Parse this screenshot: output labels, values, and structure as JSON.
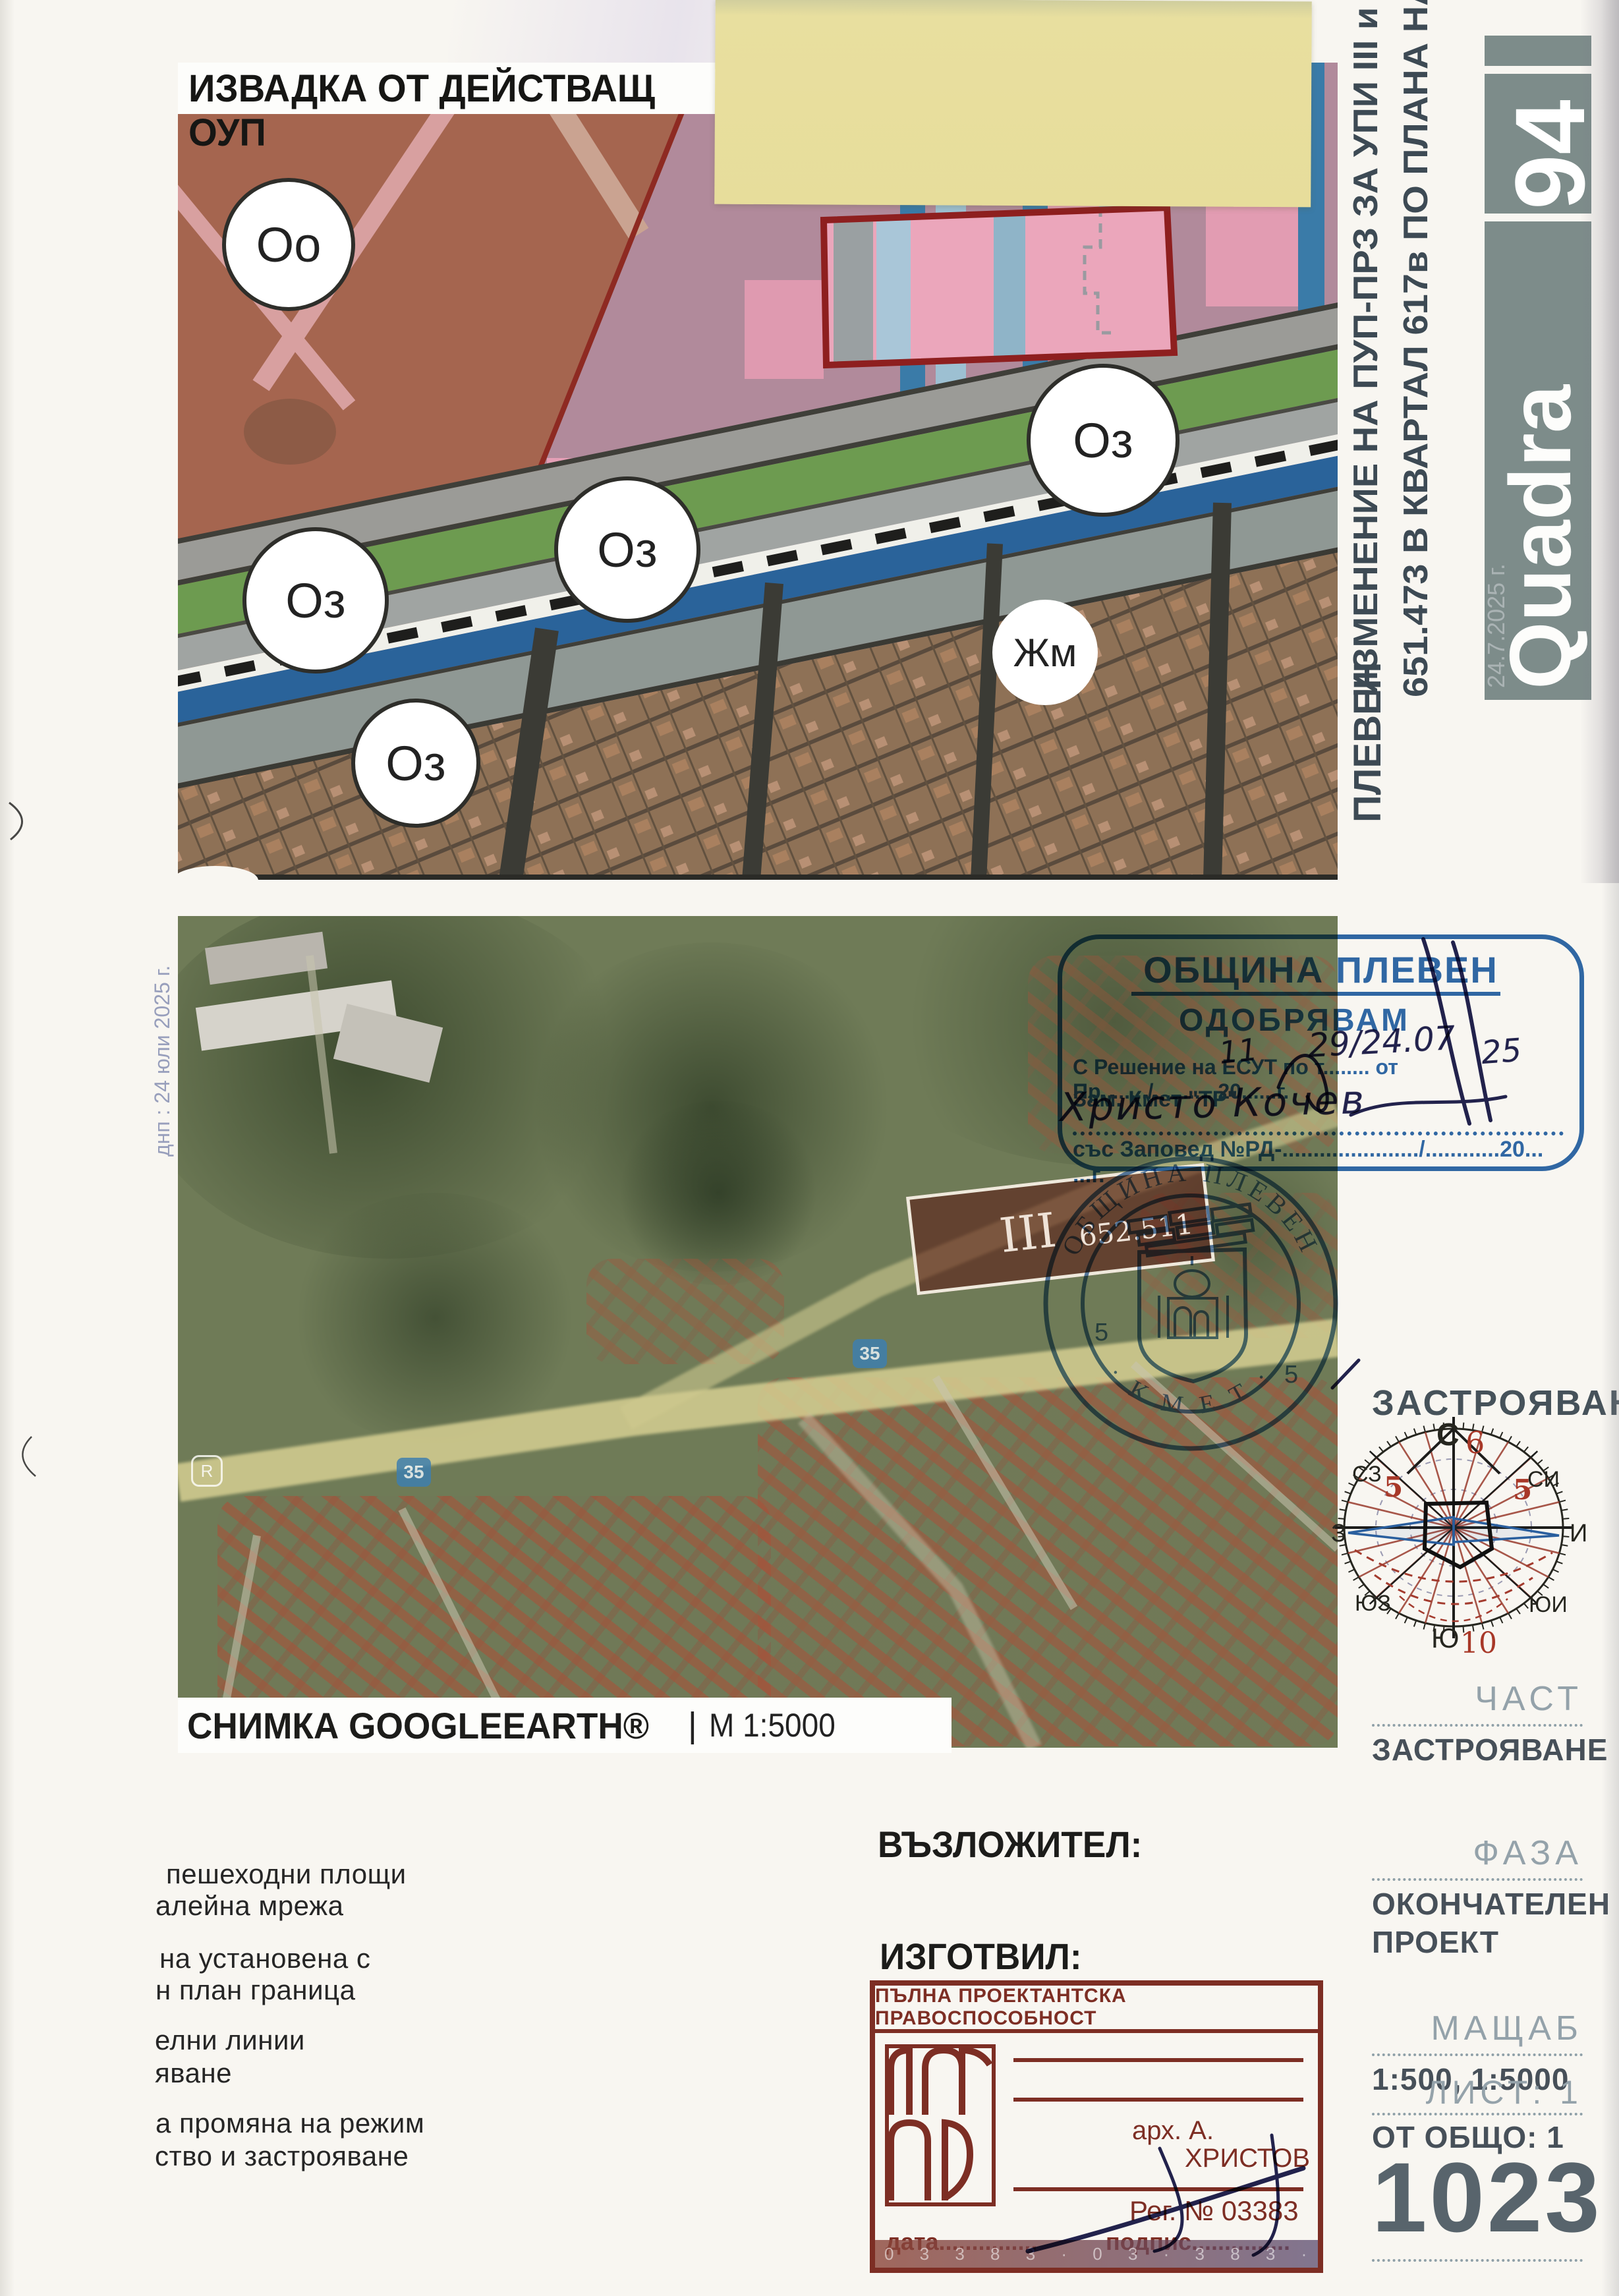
{
  "scan": {
    "fold_note": "днп : 24 юли 2025 г."
  },
  "zoning": {
    "title": "ИЗВАДКА ОТ ДЕЙСТВАЩ ОУП",
    "zones": [
      {
        "label": "Оо"
      },
      {
        "label": "Оз"
      },
      {
        "label": "Оз"
      },
      {
        "label": "Оз"
      },
      {
        "label": "Оз"
      },
      {
        "label": "Жм"
      }
    ]
  },
  "side": {
    "project_line1": "ИЗМЕНЕНИЕ  НА  ПУП-ПРЗ  ЗА  УПИ  III  и  ПИ",
    "project_line2": "651.473 В КВАРТАЛ 617в ПО ПЛАНА НА ГРАД",
    "project_line3": "ПЛЕВЕН",
    "logo_number": "94",
    "logo_brand": "Quadra",
    "logo_watermark": "24.7.2025 г."
  },
  "approval": {
    "municipality": "ОБЩИНА ПЛЕВЕН",
    "approve": "ОДОБРЯВАМ",
    "line_resolution": "С Решение на ЕСУТ по т........ от Пр......../...........20......г.",
    "line_role": "Зам. Кмет \"ТР\"",
    "line_order": "със Заповед №РД-....................../............20... ...г.",
    "hand_item": "11",
    "hand_protocol": "29/24.07",
    "hand_year": "25",
    "hand_name": "Христо Кочев"
  },
  "round": {
    "top_text": "ОБЩИНА ПЛЕВЕН",
    "bottom_text": "· К М Е Т ·",
    "left_num": "5",
    "right_num": "5"
  },
  "satellite": {
    "parcel_roman": "III",
    "parcel_number": "652.511",
    "route_a": "35",
    "route_b": "35",
    "logo_r": "R",
    "caption_title": "СНИМКА GOOGLEEARTH®",
    "caption_sep": "|",
    "caption_scale": "М 1:5000"
  },
  "compass": {
    "heading": "ЗАСТРОЯВАНЕ",
    "n": "С",
    "s": "Ю",
    "w": "З",
    "e": "И",
    "nw": "СЗ",
    "ne": "СИ",
    "sw": "ЮЗ",
    "se": "ЮИ",
    "num_top": "6",
    "num_bottom": "10",
    "num_left": "5",
    "num_right": "5"
  },
  "titleblock": {
    "part_label": "ЧАСТ",
    "part_value": "ЗАСТРОЯВАНЕ",
    "phase_label": "ФАЗА",
    "phase_value1": "ОКОНЧАТЕЛЕН",
    "phase_value2": "ПРОЕКТ",
    "scale_label": "МАЩАБ",
    "scale_value": "1:500, 1:5000",
    "sheet_label": "ЛИСТ: 1",
    "sheet_total": "ОТ ОБЩО: 1",
    "doc_number": "1023"
  },
  "sections": {
    "client_label": "ВЪЗЛОЖИТЕЛ:",
    "author_label": "ИЗГОТВИЛ:"
  },
  "arch": {
    "header": "ПЪЛНА ПРОЕКТАНТСКА ПРАВОСПОСОБНОСТ",
    "name1": "арх. А.",
    "name2": "ХРИСТОВ",
    "reg": "Рег. № 03383",
    "date_label": "дата...............",
    "sign_label": "подпис...............",
    "serial": "0 3 3 8 3 · 0 3 · 3 8 3 · 0 3 3 8 3"
  },
  "legend": {
    "lines": [
      "пешеходни площи",
      "алейна мрежа",
      "на установена с",
      "н план граница",
      "елни линии",
      "яване",
      "а промяна на режим",
      "ство и застрояване"
    ]
  }
}
